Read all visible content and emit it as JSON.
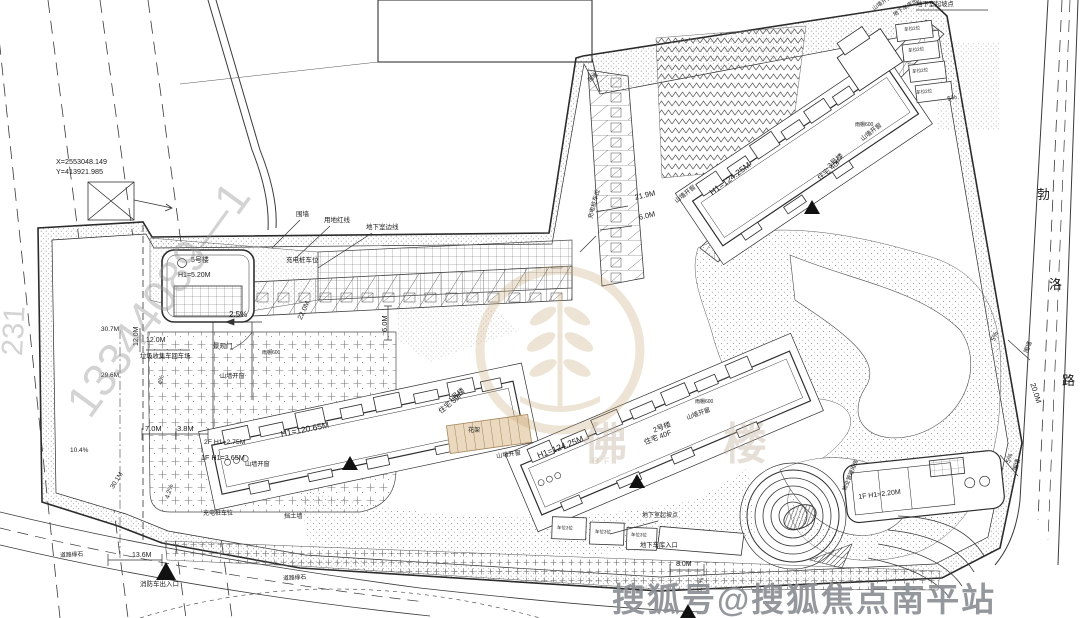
{
  "watermarks": {
    "sohu": "搜狐号@搜狐焦点南平站",
    "serial_diagonal": "13344089—1",
    "serial_left": "231",
    "logo_char_1": "佛",
    "logo_char_2": "楼",
    "logo_sub": "OF"
  },
  "survey_point": {
    "x": "X=2553048.149",
    "y": "Y=413921.985"
  },
  "road": {
    "name_char_1": "勃",
    "name_char_2": "洛",
    "name_char_3": "路",
    "width": "20.0M"
  },
  "buildings": {
    "tower1": {
      "no": "1号楼",
      "use": "住宅 39F",
      "height": "H1=120.65M"
    },
    "tower2": {
      "no": "2号楼",
      "use": "住宅 40F",
      "height": "H1=124.25M"
    },
    "tower3": {
      "no": "3号楼",
      "use": "住宅 40F",
      "height": "H1=124.25M"
    },
    "gatehouse": {
      "no": "5号楼",
      "height": "H1=5.20M"
    },
    "podium": {
      "f1": "1F H1=3.65M",
      "f2": "2F H1=2.75M"
    },
    "property_mgmt": {
      "label": "物业管理用房",
      "height": "1F H1=2.20M"
    }
  },
  "annotations": {
    "fence": "围墙",
    "red_line": "用地红线",
    "basement_edge": "地下室边线",
    "charging_stalls": "充电桩车位",
    "gable_window": "山墙开窗",
    "canopy": "雨棚600",
    "landscape_gate": "景观门",
    "garbage_turnaround": "垃圾收集车回车场",
    "fire_entrance": "消防车出入口",
    "garage_entrance": "地下车库入口",
    "garage_exit": "地下车库出入口",
    "basement_slope_start": "地下室起坡点",
    "retaining_wall": "挡土墙",
    "pergola": "花架",
    "curb": "道路缘石",
    "stall_box_2": "车位2位",
    "stall_box_3": "车位3位"
  },
  "dimensions": {
    "d21_9": "21.9M",
    "d6_0": "6.0M",
    "s2_5": "2.5%",
    "d22_0": "22.0M",
    "d12_0": "12.0M",
    "d30_7": "30.7M",
    "d29_6": "29.6M",
    "d7_0": "7.0M",
    "d3_8": "3.8M",
    "s4": "4%",
    "s4_2": "4.2%",
    "s10_4": "10.4%",
    "d30_1": "30.1M",
    "d13_6": "13.6M",
    "d8_0": "8.0M",
    "s6_7": "6.7%",
    "s5": "5%",
    "d20_0": "20.0M"
  }
}
